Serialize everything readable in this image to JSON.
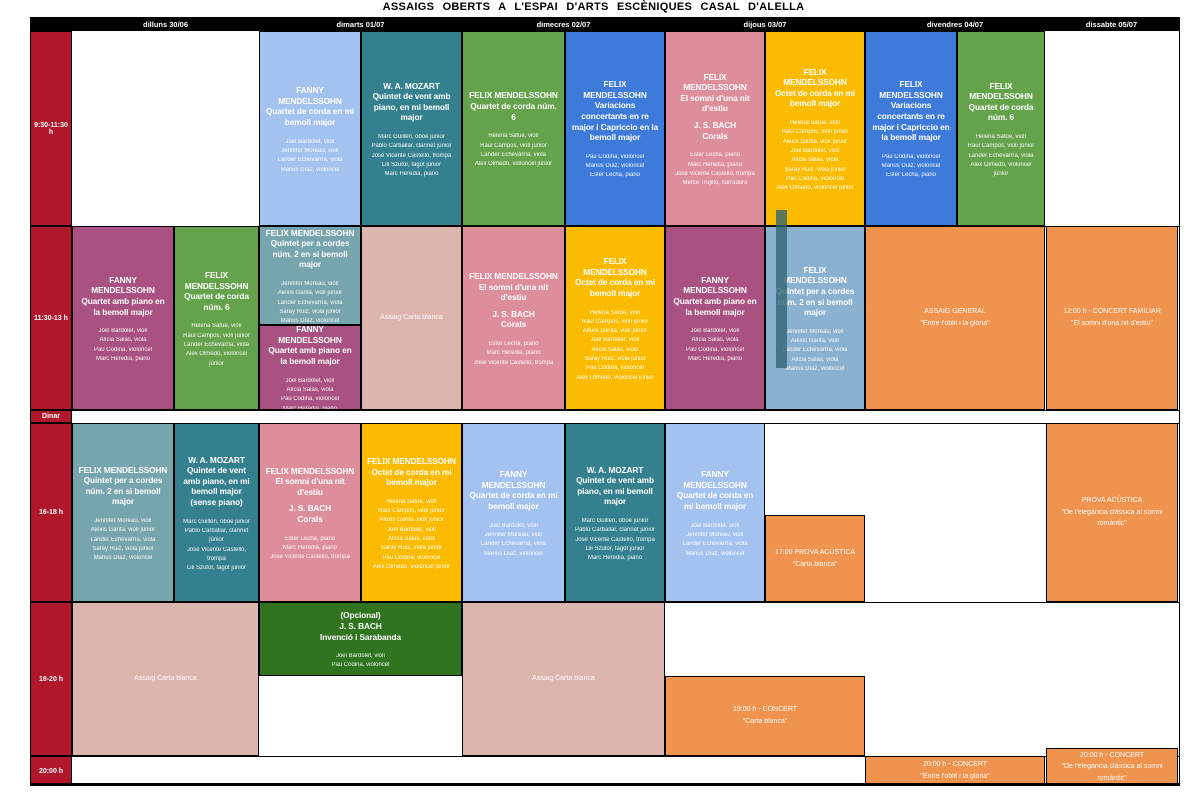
{
  "title": "ASSAIGS OBERTS A L'ESPAI D'ARTS ESCÈNIQUES CASAL D'ALELLA",
  "days": [
    {
      "id": "dilluns",
      "label": "dilluns 30/06"
    },
    {
      "id": "dimarts",
      "label": "dimarts 01/07"
    },
    {
      "id": "dimecres",
      "label": "dimecres 02/07"
    },
    {
      "id": "dijous",
      "label": "dijous 03/07"
    },
    {
      "id": "divendres",
      "label": "divendres 04/07"
    },
    {
      "id": "dissabte",
      "label": "dissabte 05/07"
    }
  ],
  "time_slots": [
    {
      "id": "r1",
      "label": "9:30-11:30 h"
    },
    {
      "id": "r2",
      "label": "11:30-13 h"
    },
    {
      "id": "dinar",
      "label": "Dinar"
    },
    {
      "id": "r3",
      "label": "16-18 h"
    },
    {
      "id": "r4",
      "label": "18-20 h"
    },
    {
      "id": "r5",
      "label": "20:00 h"
    }
  ],
  "colors": {
    "header_bg": "#000000",
    "time_column": "#B0172B",
    "lightblue": "#A4C2EF",
    "teal": "#35808F",
    "green": "#64A34C",
    "blue": "#3D7AD9",
    "rose": "#DE8E9A",
    "yellow": "#FABB00",
    "magenta": "#A95180",
    "slate": "#77A5AE",
    "steelblue": "#8BB1D0",
    "dustypink": "#DCB5AF",
    "orange": "#F0934E",
    "darkgreen": "#30741F",
    "accent_bar": "#2F6472"
  },
  "events": [
    {
      "name": "r1-tue1",
      "row": "r1",
      "col": "tue1",
      "color": "lightblue",
      "blocks": [
        [
          "FANNY MENDELSSOHN",
          "Quartet de corda en mi bemoll major"
        ]
      ],
      "performers": [
        "Joel Bardolet, violí",
        "Jennifer Moreau, violí",
        "Lander Echevarría, viola",
        "Màrius Díaz, violoncel"
      ]
    },
    {
      "name": "r1-tue2",
      "row": "r1",
      "col": "tue2",
      "color": "teal",
      "blocks": [
        [
          "W. A. MOZART",
          "Quintet de vent amb piano, en mi bemoll major"
        ]
      ],
      "performers": [
        "Marc Guillén, oboè júnior",
        "Pablo Carballar, clarinet júnior",
        "José Vicente Castelló, trompa",
        "Lili Szutor, fagot júnior",
        "Marc Heredia, piano"
      ]
    },
    {
      "name": "r1-wed1",
      "row": "r1",
      "col": "wed1",
      "color": "green",
      "blocks": [
        [
          "FELIX MENDELSSOHN",
          "Quartet de corda núm. 6"
        ]
      ],
      "performers": [
        "Helena Satué, violí",
        "Raul Campos, violí júnior",
        "Lander Echevarría, viola",
        "Alex Olmedo, violoncel júnior"
      ]
    },
    {
      "name": "r1-wed2",
      "row": "r1",
      "col": "wed2",
      "color": "blue",
      "blocks": [
        [
          "FELIX MENDELSSOHN",
          "Variacions concertants en re major i Capriccio en la bemoll major"
        ]
      ],
      "performers": [
        "Pau Codina, violoncel",
        "Màrius Díaz, violoncel",
        "Ester Lecha, piano"
      ]
    },
    {
      "name": "r1-thu1",
      "row": "r1",
      "col": "thu1",
      "color": "rose",
      "blocks": [
        [
          "FELIX MENDELSSOHN",
          "El somni d'una nit d'estiu"
        ],
        [
          "J. S. BACH",
          "Corals"
        ]
      ],
      "performers": [
        "Ester Lecha, piano",
        "Marc Heredia, piano",
        "José Vicente Castelló, trompa",
        "Mercè Trujillo, narradora"
      ]
    },
    {
      "name": "r1-thu2",
      "row": "r1",
      "col": "thu2",
      "color": "yellow",
      "blocks": [
        [
          "FELIX MENDELSSOHN",
          "Octet de corda en mi bemoll major"
        ]
      ],
      "performers": [
        "Helena Satué, violí",
        "Raul Campos, violí júnior",
        "Alexis Garita, violí júnior",
        "Joel Bardolet, violí",
        "Alícia Salas, viola",
        "Saray Ruiz, viola júnior",
        "Pau Codina, violoncel",
        "Alex Olmedo, violoncel júnior"
      ]
    },
    {
      "name": "r1-fri1",
      "row": "r1",
      "col": "fri1",
      "color": "blue",
      "blocks": [
        [
          "FELIX MENDELSSOHN",
          "Variacions concertants en re major i Capriccio en la bemoll major"
        ]
      ],
      "performers": [
        "Pau Codina, violoncel",
        "Màrius Díaz, violoncel",
        "Ester Lecha, piano"
      ]
    },
    {
      "name": "r1-fri2",
      "row": "r1",
      "col": "fri2",
      "color": "green",
      "blocks": [
        [
          "FELIX MENDELSSOHN",
          "Quartet de corda núm. 6"
        ]
      ],
      "performers": [
        "Helena Satué, violí",
        "Raul Campos, violí júnior",
        "Lander Echevarría, viola",
        "Alex Olmedo, violoncel júnior"
      ]
    },
    {
      "name": "r2-mon1",
      "row": "r2",
      "col": "mon1",
      "color": "magenta",
      "blocks": [
        [
          "FANNY MENDELSSOHN",
          "Quartet amb piano en la bemoll major"
        ]
      ],
      "performers": [
        "Joel Bardolet, violí",
        "Alícia Salas, viola",
        "Pau Codina, violoncel",
        "Marc Heredia, piano"
      ]
    },
    {
      "name": "r2-mon2",
      "row": "r2",
      "col": "mon2",
      "color": "green",
      "blocks": [
        [
          "FELIX MENDELSSOHN",
          "Quartet de corda núm. 6"
        ]
      ],
      "performers": [
        "Helena Satué, violí",
        "Raul Campos, violí júnior",
        "Lander Echevarría, viola",
        "Alex Olmedo, violoncel júnior"
      ]
    },
    {
      "name": "r2-tue1-top",
      "row": "r2",
      "col": "tue1",
      "vpos": "top",
      "color": "slate",
      "blocks": [
        [
          "FELIX MENDELSSOHN",
          "Quintet per a cordes núm. 2 en si bemoll major"
        ]
      ],
      "performers": [
        "Jennifer Moreau, violí",
        "Alexis Garita, violí júnior",
        "Lander Echevarría, viola",
        "Saray Ruiz, viola júnior",
        "Màrius Díaz, violoncel"
      ]
    },
    {
      "name": "r2-tue1-bottom",
      "row": "r2",
      "col": "tue1",
      "vpos": "bottom",
      "color": "magenta",
      "blocks": [
        [
          "FANNY MENDELSSOHN",
          "Quartet amb piano en la bemoll major"
        ]
      ],
      "performers": [
        "Joel Bardolet, violí",
        "Alícia Salas, viola",
        "Pau Codina, violoncel",
        "Marc Heredia, piano"
      ]
    },
    {
      "name": "r2-tue2",
      "row": "r2",
      "col": "tue2",
      "color": "dustypink",
      "plain": true,
      "blocks": [
        [
          "Assaig Carta blanca"
        ]
      ],
      "performers": []
    },
    {
      "name": "r2-wed1",
      "row": "r2",
      "col": "wed1",
      "color": "rose",
      "blocks": [
        [
          "FELIX MENDELSSOHN",
          "El somni d'una nit d'estiu"
        ],
        [
          "J. S. BACH",
          "Corals"
        ]
      ],
      "performers": [
        "Ester Lecha, piano",
        "Marc Heredia, piano",
        "José Vicente Castelló, trompa"
      ]
    },
    {
      "name": "r2-wed2",
      "row": "r2",
      "col": "wed2",
      "color": "yellow",
      "blocks": [
        [
          "FELIX MENDELSSOHN",
          "Octet de corda en mi bemoll major"
        ]
      ],
      "performers": [
        "Helena Satué, violí",
        "Raul Campos, violí júnior",
        "Alexis Garita, violí júnior",
        "Joel Bardolet, violí",
        "Alícia Salas, viola",
        "Saray Ruiz, viola júnior",
        "Pau Codina, violoncel",
        "Alex Olmedo, violoncel júnior"
      ]
    },
    {
      "name": "r2-thu1",
      "row": "r2",
      "col": "thu1",
      "color": "magenta",
      "blocks": [
        [
          "FANNY MENDELSSOHN",
          "Quartet amb piano en la bemoll major"
        ]
      ],
      "performers": [
        "Joel Bardolet, violí",
        "Alícia Salas, viola",
        "Pau Codina, violoncel",
        "Marc Heredia, piano"
      ]
    },
    {
      "name": "r2-thu2",
      "row": "r2",
      "col": "thu2",
      "color": "steelblue",
      "blocks": [
        [
          "FELIX MENDELSSOHN",
          "Quintet per a cordes núm. 2 en si bemoll major"
        ]
      ],
      "performers": [
        "Jennifer Moreau, violí",
        "Alexis Garita, violí",
        "Lander Echevarría, viola",
        "Alícia Salas, viola",
        "Màrius Díaz, violoncel"
      ]
    },
    {
      "name": "r2-fri",
      "row": "r2",
      "col": "fri1",
      "col2": "fri2",
      "color": "orange",
      "plain": true,
      "blocks": [
        [
          "ASSAIG GENERAL",
          "\"Entre l'oblit i la glòria\""
        ]
      ],
      "performers": []
    },
    {
      "name": "r2-sat",
      "row": "r2",
      "col": "sat",
      "color": "orange",
      "plain": true,
      "blocks": [
        [
          "12:00 h - CONCERT FAMILIAR",
          "\"El somni d'una nit d'estiu\""
        ]
      ],
      "performers": []
    },
    {
      "name": "r3-mon1",
      "row": "r3",
      "col": "mon1",
      "color": "slate",
      "blocks": [
        [
          "FELIX MENDELSSOHN",
          "Quintet per a cordes núm. 2 en si bemoll major"
        ]
      ],
      "performers": [
        "Jennifer Moreau, violí",
        "Alexis Garita, violí júnior",
        "Lander Echevarría, viola",
        "Saray Ruiz, viola júnior",
        "Màrius Díaz, violoncel"
      ]
    },
    {
      "name": "r3-mon2",
      "row": "r3",
      "col": "mon2",
      "color": "teal",
      "blocks": [
        [
          "W. A. MOZART",
          "Quintet de vent amb piano, en mi bemoll major",
          "(sense piano)"
        ]
      ],
      "performers": [
        "Marc Guillén, oboè júnior",
        "Pablo Carballar, clarinet júnior",
        "José Vicente Castelló, trompa",
        "Lili Szutor, fagot júnior"
      ]
    },
    {
      "name": "r3-tue1",
      "row": "r3",
      "col": "tue1",
      "color": "rose",
      "blocks": [
        [
          "FELIX MENDELSSOHN",
          "El somni d'una nit d'estiu"
        ],
        [
          "J. S. BACH",
          "Corals"
        ]
      ],
      "performers": [
        "Ester Lecha, piano",
        "Marc Heredia, piano",
        "José Vicente Castelló, trompa"
      ]
    },
    {
      "name": "r3-tue2",
      "row": "r3",
      "col": "tue2",
      "color": "yellow",
      "blocks": [
        [
          "FELIX MENDELSSOHN",
          "Octet de corda en mi bemoll major"
        ]
      ],
      "performers": [
        "Helena Satué, violí",
        "Raul Campos, violí júnior",
        "Alexis Garita, violí júnior",
        "Joel Bardolet, violí",
        "Alícia Salas, viola",
        "Saray Ruiz, viola júnior",
        "Pau Codina, violoncel",
        "Alex Olmedo, violoncel júnior"
      ]
    },
    {
      "name": "r3-wed1",
      "row": "r3",
      "col": "wed1",
      "color": "lightblue",
      "blocks": [
        [
          "FANNY MENDELSSOHN",
          "Quartet de corda en mi bemoll major"
        ]
      ],
      "performers": [
        "Joel Bardolet, violí",
        "Jennifer Moreau, violí",
        "Lander Echevarría, viola",
        "Màrius Díaz, violoncel"
      ]
    },
    {
      "name": "r3-wed2",
      "row": "r3",
      "col": "wed2",
      "color": "teal",
      "blocks": [
        [
          "W. A. MOZART",
          "Quintet de vent amb piano, en mi bemoll major"
        ]
      ],
      "performers": [
        "Marc Guillén, oboè júnior",
        "Pablo Carballar, clarinet júnior",
        "José Vicente Castelló, trompa",
        "Lili Szutor, fagot júnior",
        "Marc Heredia, piano"
      ]
    },
    {
      "name": "r3-thu1",
      "row": "r3",
      "col": "thu1",
      "color": "lightblue",
      "blocks": [
        [
          "FANNY MENDELSSOHN",
          "Quartet de corda en mi bemoll major"
        ]
      ],
      "performers": [
        "Joel Bardolet, violí",
        "Jennifer Moreau, violí",
        "Lander Echevarría, viola",
        "Màrius Díaz, violoncel"
      ]
    },
    {
      "name": "r3-thu2",
      "row": "r3",
      "col": "thu2",
      "vpos": "bottom",
      "color": "orange",
      "plain": true,
      "blocks": [
        [
          "17:00 PROVA ACÚSTICA",
          "\"Carta blanca\""
        ]
      ],
      "performers": []
    },
    {
      "name": "r3-sat",
      "row": "r3",
      "col": "sat",
      "color": "orange",
      "plain": true,
      "blocks": [
        [
          "PROVA ACÚSTICA",
          "\"De l'elegància clàssica al somni romàntic\""
        ]
      ],
      "performers": []
    },
    {
      "name": "r4-mon",
      "row": "r4",
      "col": "mon1",
      "col2": "mon2",
      "color": "dustypink",
      "plain": true,
      "blocks": [
        [
          "Assaig Carta blanca"
        ]
      ],
      "performers": []
    },
    {
      "name": "r4-tue",
      "row": "r4",
      "col": "tue1",
      "col2": "tue2",
      "vpos": "top",
      "color": "darkgreen",
      "blocks": [
        [
          "(Opcional)",
          "J. S. BACH",
          "Invenció i Sarabanda"
        ]
      ],
      "performers": [
        "Joel Bardolet, violí",
        "Pau Codina, violoncel"
      ]
    },
    {
      "name": "r4-wed",
      "row": "r4",
      "col": "wed1",
      "col2": "wed2",
      "color": "dustypink",
      "plain": true,
      "blocks": [
        [
          "Assaig Carta blanca"
        ]
      ],
      "performers": []
    },
    {
      "name": "r4-thu",
      "row": "r4",
      "col": "thu1",
      "col2": "thu2",
      "vpos": "bottom",
      "color": "orange",
      "plain": true,
      "blocks": [
        [
          "19:00 h - CONCERT",
          "\"Carta blanca\""
        ]
      ],
      "performers": []
    },
    {
      "name": "r5-fri",
      "row": "r5",
      "col": "fri1",
      "col2": "fri2",
      "color": "orange",
      "plain": true,
      "blocks": [
        [
          "20:00 h - CONCERT",
          "\"Entre l'oblit i la glòria\""
        ]
      ],
      "performers": []
    },
    {
      "name": "r5-sat",
      "row": "r5",
      "col": "sat",
      "vpos": "tall",
      "color": "orange",
      "plain": true,
      "blocks": [
        [
          "20:00 h - CONCERT",
          "\"De l'elegància clàssica al somni romàntic\""
        ]
      ],
      "performers": []
    }
  ]
}
